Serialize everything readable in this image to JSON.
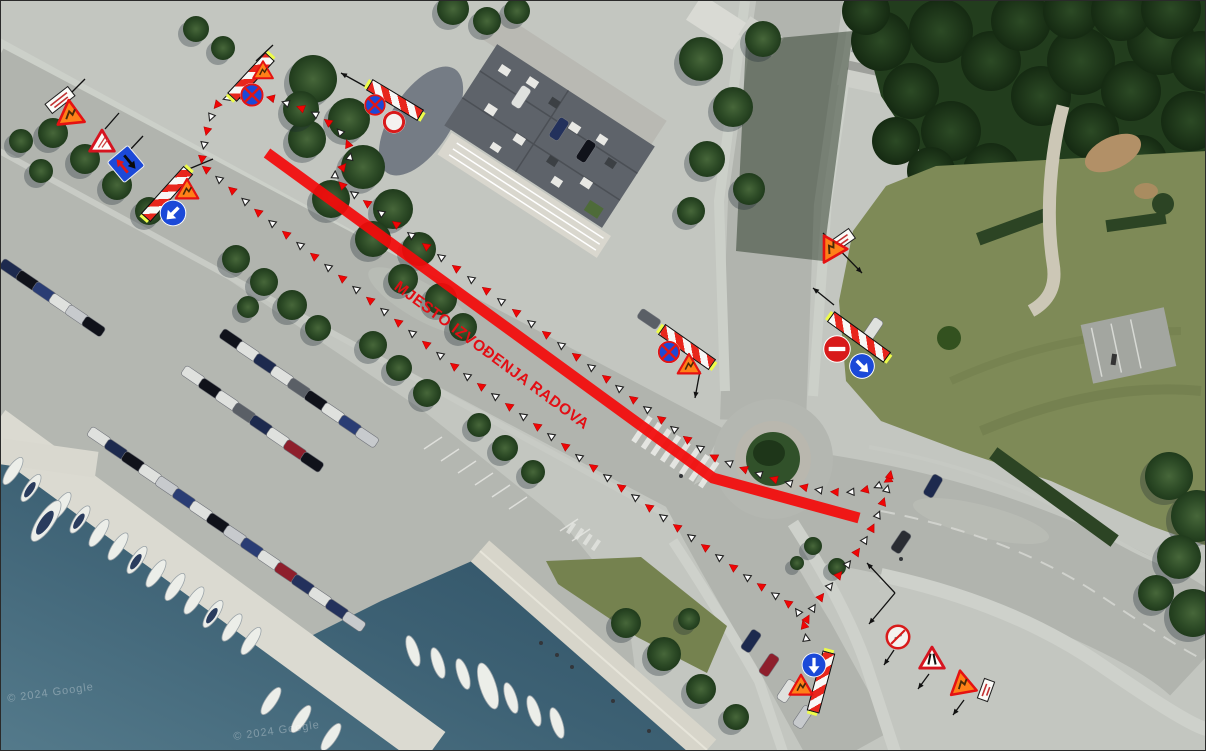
{
  "overlay": {
    "label": {
      "text": "MJESTO IZVOĐENJA RADOVA",
      "x": 400,
      "y": 277,
      "rot": 36.5,
      "color": "#e30e14"
    },
    "red_line": {
      "points": [
        [
          266,
          152
        ],
        [
          712,
          477
        ],
        [
          858,
          517
        ]
      ],
      "color": "#f30b0b",
      "width": 11
    },
    "marker_colors": {
      "filled": "#f00505",
      "outline_fill": "#ffffff",
      "outline_stroke": "#222222"
    }
  },
  "watermarks": [
    {
      "text": "© 2024 Google",
      "x": 6,
      "y": 686
    },
    {
      "text": "© 2024 Google",
      "x": 232,
      "y": 724
    }
  ],
  "cone_trails": [
    {
      "name": "north-cordon",
      "points": [
        [
          201,
          158
        ],
        [
          203,
          144
        ],
        [
          206,
          130
        ],
        [
          210,
          116
        ],
        [
          216,
          104
        ],
        [
          226,
          97
        ],
        [
          240,
          96
        ],
        [
          255,
          95
        ],
        [
          270,
          97
        ],
        [
          285,
          102
        ],
        [
          300,
          107
        ],
        [
          314,
          113
        ],
        [
          327,
          121
        ],
        [
          339,
          131
        ],
        [
          347,
          143
        ],
        [
          349,
          156
        ],
        [
          342,
          166
        ],
        [
          334,
          174
        ],
        [
          341,
          184
        ],
        [
          353,
          193
        ],
        [
          366,
          202
        ],
        [
          380,
          212
        ],
        [
          395,
          223
        ],
        [
          410,
          234
        ],
        [
          425,
          245
        ],
        [
          440,
          256
        ],
        [
          455,
          267
        ],
        [
          470,
          278
        ],
        [
          485,
          289
        ],
        [
          500,
          300
        ],
        [
          515,
          311
        ],
        [
          530,
          322
        ],
        [
          545,
          333
        ],
        [
          560,
          344
        ],
        [
          575,
          355
        ],
        [
          590,
          366
        ],
        [
          605,
          377
        ],
        [
          618,
          387
        ],
        [
          632,
          398
        ],
        [
          646,
          408
        ],
        [
          660,
          418
        ],
        [
          673,
          428
        ],
        [
          686,
          438
        ],
        [
          699,
          447
        ],
        [
          713,
          456
        ],
        [
          728,
          462
        ],
        [
          743,
          468
        ],
        [
          758,
          473
        ],
        [
          773,
          478
        ],
        [
          788,
          482
        ],
        [
          803,
          486
        ],
        [
          818,
          489
        ],
        [
          834,
          491
        ],
        [
          850,
          491
        ],
        [
          864,
          489
        ],
        [
          877,
          485
        ],
        [
          887,
          479
        ]
      ]
    },
    {
      "name": "west-cordon",
      "points": [
        [
          205,
          168
        ],
        [
          218,
          178
        ],
        [
          231,
          189
        ],
        [
          244,
          200
        ],
        [
          257,
          211
        ],
        [
          271,
          222
        ],
        [
          285,
          233
        ],
        [
          299,
          244
        ],
        [
          313,
          255
        ],
        [
          327,
          266
        ],
        [
          341,
          277
        ],
        [
          355,
          288
        ],
        [
          369,
          299
        ],
        [
          383,
          310
        ],
        [
          397,
          321
        ],
        [
          411,
          332
        ],
        [
          425,
          343
        ],
        [
          439,
          354
        ],
        [
          453,
          365
        ],
        [
          466,
          375
        ],
        [
          480,
          385
        ],
        [
          494,
          395
        ],
        [
          508,
          405
        ],
        [
          522,
          415
        ],
        [
          536,
          425
        ],
        [
          550,
          435
        ],
        [
          564,
          445
        ],
        [
          578,
          456
        ],
        [
          592,
          466
        ],
        [
          606,
          476
        ],
        [
          620,
          486
        ],
        [
          634,
          496
        ],
        [
          648,
          506
        ],
        [
          662,
          516
        ],
        [
          676,
          526
        ],
        [
          690,
          536
        ],
        [
          704,
          546
        ],
        [
          718,
          556
        ],
        [
          732,
          566
        ],
        [
          746,
          576
        ],
        [
          760,
          585
        ],
        [
          774,
          594
        ],
        [
          787,
          602
        ],
        [
          797,
          611
        ],
        [
          803,
          624
        ],
        [
          805,
          637
        ]
      ]
    },
    {
      "name": "east-cordon",
      "points": [
        [
          889,
          474
        ],
        [
          886,
          488
        ],
        [
          882,
          501
        ],
        [
          877,
          514
        ],
        [
          871,
          527
        ],
        [
          864,
          539
        ],
        [
          856,
          551
        ],
        [
          847,
          563
        ],
        [
          838,
          574
        ],
        [
          829,
          585
        ],
        [
          820,
          596
        ],
        [
          812,
          607
        ],
        [
          806,
          618
        ]
      ]
    }
  ],
  "leader_lines": [
    {
      "p": [
        [
          68,
          94
        ],
        [
          84,
          78
        ]
      ]
    },
    {
      "p": [
        [
          104,
          128
        ],
        [
          118,
          112
        ]
      ]
    },
    {
      "p": [
        [
          128,
          150
        ],
        [
          142,
          135
        ]
      ]
    },
    {
      "p": [
        [
          183,
          170
        ],
        [
          212,
          158
        ]
      ]
    },
    {
      "p": [
        [
          255,
          60
        ],
        [
          272,
          44
        ]
      ]
    },
    {
      "p": [
        [
          340,
          72
        ],
        [
          376,
          92
        ]
      ],
      "head": "start"
    },
    {
      "p": [
        [
          699,
          370
        ],
        [
          694,
          397
        ]
      ],
      "head": "end"
    },
    {
      "p": [
        [
          822,
          232
        ],
        [
          861,
          272
        ]
      ],
      "head": "end"
    },
    {
      "p": [
        [
          833,
          304
        ],
        [
          812,
          287
        ]
      ],
      "head": "end"
    },
    {
      "p": [
        [
          893,
          649
        ],
        [
          883,
          664
        ]
      ],
      "head": "end"
    },
    {
      "p": [
        [
          928,
          673
        ],
        [
          917,
          688
        ]
      ],
      "head": "end"
    },
    {
      "p": [
        [
          963,
          699
        ],
        [
          952,
          714
        ]
      ],
      "head": "end"
    },
    {
      "p": [
        [
          894,
          592
        ],
        [
          866,
          562
        ]
      ],
      "head": "end"
    },
    {
      "p": [
        [
          894,
          592
        ],
        [
          868,
          623
        ]
      ],
      "head": "end"
    }
  ],
  "signs": [
    {
      "type": "plate",
      "name": "info-plate",
      "x": 59,
      "y": 99,
      "rot": -38,
      "w": 30,
      "h": 13
    },
    {
      "type": "tri_orange",
      "name": "roadworks-warning-triangle",
      "x": 69,
      "y": 111,
      "rot": -6,
      "s": 30
    },
    {
      "type": "tri_warn",
      "name": "warning-triangle",
      "glyph": "hatch",
      "x": 101,
      "y": 140,
      "rot": 0,
      "s": 29
    },
    {
      "type": "square_priority",
      "name": "priority-oncoming-traffic-sign",
      "x": 125,
      "y": 163,
      "rot": -40,
      "s": 28
    },
    {
      "type": "barrier",
      "name": "roadwork-barrier",
      "x": 166,
      "y": 193,
      "rot": 42,
      "len": 64
    },
    {
      "type": "tri_orange",
      "name": "roadworks-warning-triangle",
      "x": 186,
      "y": 188,
      "rot": 0,
      "s": 25
    },
    {
      "type": "circle_arrow",
      "name": "keep-left-sign",
      "x": 172,
      "y": 212,
      "d": 28,
      "adeg": 45
    },
    {
      "type": "barrier",
      "name": "roadwork-barrier",
      "x": 250,
      "y": 76,
      "rot": 43,
      "len": 56
    },
    {
      "type": "tri_orange",
      "name": "roadworks-warning-triangle",
      "x": 262,
      "y": 69,
      "rot": 0,
      "s": 22
    },
    {
      "type": "circle_x",
      "name": "no-stopping-sign",
      "x": 251,
      "y": 94,
      "d": 25
    },
    {
      "type": "barrier",
      "name": "roadwork-barrier",
      "x": 394,
      "y": 99,
      "rot": -59,
      "len": 60
    },
    {
      "type": "circle_x",
      "name": "no-stopping-sign",
      "x": 374,
      "y": 104,
      "d": 23
    },
    {
      "type": "circle_ring",
      "name": "no-vehicles-sign",
      "x": 393,
      "y": 121,
      "d": 24
    },
    {
      "type": "barrier",
      "name": "roadwork-barrier",
      "x": 686,
      "y": 346,
      "rot": -55,
      "len": 62
    },
    {
      "type": "circle_x",
      "name": "no-stopping-sign",
      "x": 668,
      "y": 351,
      "d": 24
    },
    {
      "type": "tri_orange",
      "name": "roadworks-warning-triangle",
      "x": 688,
      "y": 363,
      "rot": 0,
      "s": 25
    },
    {
      "type": "plate",
      "name": "info-plate",
      "x": 840,
      "y": 240,
      "rot": -35,
      "w": 28,
      "h": 13
    },
    {
      "type": "tri_orange",
      "name": "roadworks-warning-triangle",
      "x": 829,
      "y": 245,
      "rot": -30,
      "s": 30
    },
    {
      "type": "barrier",
      "name": "roadwork-barrier",
      "x": 858,
      "y": 336,
      "rot": -54,
      "len": 70
    },
    {
      "type": "circle_noentry",
      "name": "no-entry-sign",
      "x": 836,
      "y": 348,
      "d": 29
    },
    {
      "type": "circle_arrow",
      "name": "mandatory-direction-right-sign",
      "x": 861,
      "y": 365,
      "d": 27,
      "adeg": -45
    },
    {
      "type": "barrier",
      "name": "roadwork-barrier",
      "x": 820,
      "y": 681,
      "rot": 15,
      "len": 62
    },
    {
      "type": "circle_arrow",
      "name": "mandatory-direction-straight-sign",
      "x": 813,
      "y": 664,
      "d": 26,
      "adeg": 0
    },
    {
      "type": "tri_orange",
      "name": "roadworks-warning-triangle",
      "x": 800,
      "y": 684,
      "rot": 0,
      "s": 26
    },
    {
      "type": "circle_prohib",
      "name": "no-parking-sign",
      "x": 897,
      "y": 636,
      "d": 25
    },
    {
      "type": "tri_warn",
      "name": "road-narrows-warning-triangle",
      "glyph": "narrow",
      "x": 931,
      "y": 657,
      "rot": 0,
      "s": 29
    },
    {
      "type": "tri_orange",
      "name": "roadworks-warning-triangle",
      "x": 961,
      "y": 681,
      "rot": -10,
      "s": 29
    },
    {
      "type": "plate",
      "name": "info-plate",
      "x": 985,
      "y": 689,
      "rot": -70,
      "w": 22,
      "h": 12
    }
  ]
}
